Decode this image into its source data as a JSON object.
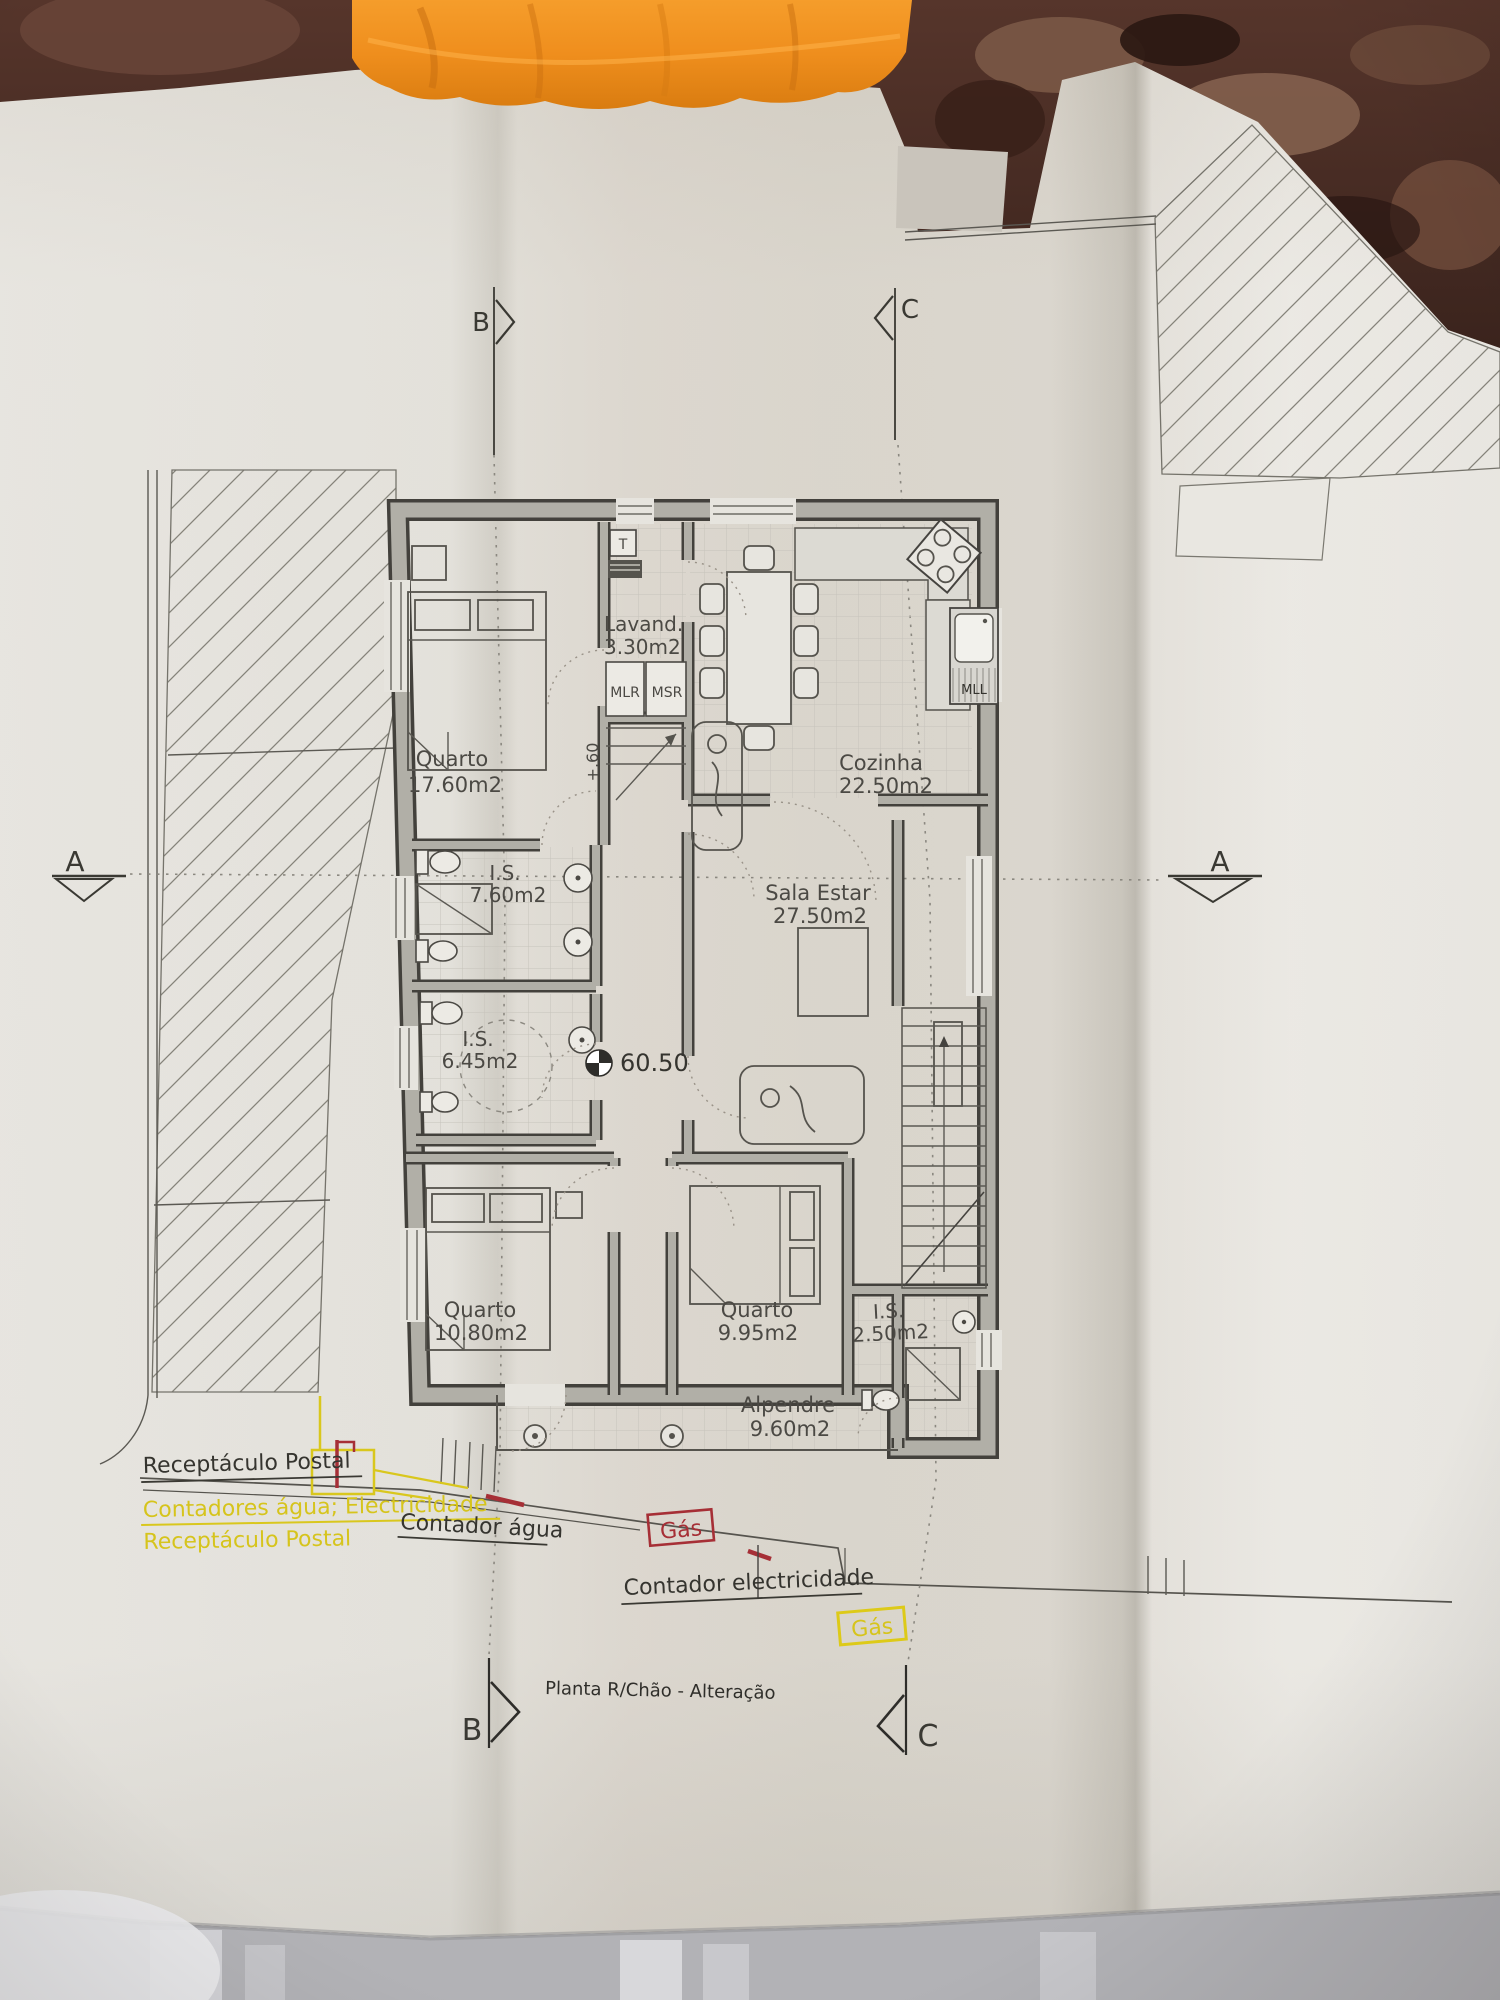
{
  "photo": {
    "towel_color": "#ef8e1d",
    "background_color": "#43271f",
    "paper_color": "#e6e4de"
  },
  "plan": {
    "title": "Planta R/Chão - Alteração",
    "rooms": {
      "quarto1": {
        "name": "Quarto",
        "area": "17.60m2"
      },
      "lavandaria": {
        "name": "Lavand.",
        "area": "3.30m2"
      },
      "cozinha": {
        "name": "Cozinha",
        "area": "22.50m2"
      },
      "is1": {
        "name": "I.S.",
        "area": "7.60m2"
      },
      "sala": {
        "name": "Sala Estar",
        "area": "27.50m2"
      },
      "is2": {
        "name": "I.S.",
        "area": "6.45m2"
      },
      "quarto2": {
        "name": "Quarto",
        "area": "10.80m2"
      },
      "quarto3": {
        "name": "Quarto",
        "area": "9.95m2"
      },
      "is3": {
        "name": "I.S.",
        "area": "2.50m2"
      },
      "alpendre": {
        "name": "Alpendre",
        "area": "9.60m2"
      }
    },
    "fixtures": {
      "t": "T",
      "mlr": "MLR",
      "msr": "MSR",
      "mll": "MLL"
    },
    "levels": {
      "ground": "60.50",
      "step": "+.60"
    },
    "sections": {
      "b_top": "B",
      "c_top": "C",
      "a_left": "A",
      "a_right": "A",
      "b_bottom": "B",
      "c_bottom": "C"
    }
  },
  "annotations": {
    "postal_box": "Receptáculo Postal",
    "meters": "Contadores água; Electricidade",
    "postal_box2": "Receptáculo Postal",
    "water_meter": "Contador água",
    "gas1": "Gás",
    "electricity_meter": "Contador electricidade",
    "gas2": "Gás",
    "colors": {
      "highlight_yellow": "#d9c71d",
      "utility_red": "#a62f36"
    }
  }
}
